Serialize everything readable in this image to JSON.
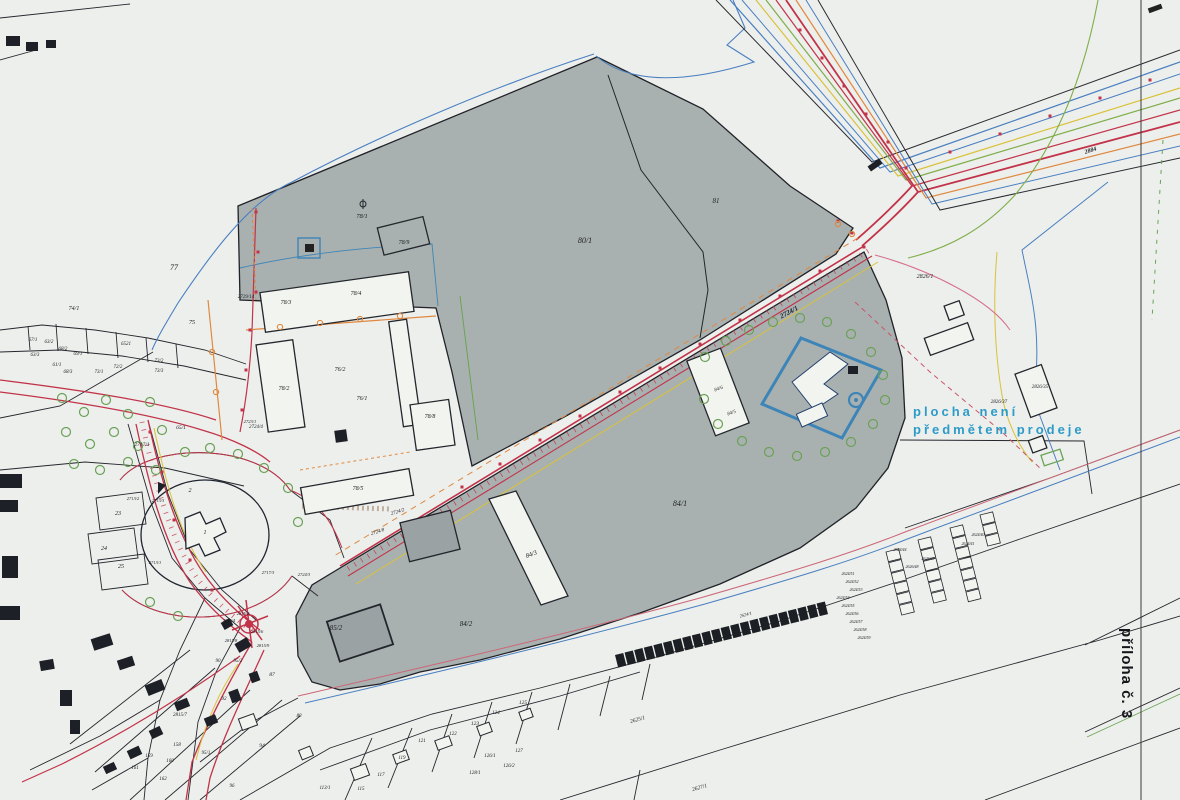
{
  "map": {
    "title": "cadastral-map-scan",
    "annotation_not_for_sale": {
      "line1": "plocha není",
      "line2": "předmětem prodeje",
      "color": "#2d9bc8"
    },
    "attachment_note": "příloha č. 3",
    "main_road_parcel": "2724/1"
  },
  "colors": {
    "paper": "#edefec",
    "parcel_gray": "#a9b1b0",
    "boundary": "#23262c",
    "utility_red": "#c23349",
    "utility_orange": "#e0883f",
    "utility_yellow": "#d9c23a",
    "utility_green": "#6aa455",
    "utility_blue": "#4a7fc1",
    "compound_blue": "#3d85b8",
    "annotation_blue": "#2d9bc8"
  },
  "parcel_labels": [
    {
      "x": 585,
      "y": 243,
      "t": "80/1",
      "fs": 8
    },
    {
      "x": 716,
      "y": 203,
      "t": "81",
      "fs": 7
    },
    {
      "x": 174,
      "y": 270,
      "t": "77",
      "fs": 8
    },
    {
      "x": 74,
      "y": 310,
      "t": "74/1",
      "fs": 6
    },
    {
      "x": 192,
      "y": 324,
      "t": "75",
      "fs": 6
    },
    {
      "x": 362,
      "y": 218,
      "t": "78/1",
      "fs": 6.5
    },
    {
      "x": 404,
      "y": 244,
      "t": "78/9",
      "fs": 6
    },
    {
      "x": 246,
      "y": 298,
      "t": "2729/14",
      "fs": 5
    },
    {
      "x": 286,
      "y": 304,
      "t": "78/3",
      "fs": 6
    },
    {
      "x": 356,
      "y": 295,
      "t": "78/4",
      "fs": 6
    },
    {
      "x": 284,
      "y": 390,
      "t": "78/2",
      "fs": 6
    },
    {
      "x": 340,
      "y": 371,
      "t": "76/2",
      "fs": 6
    },
    {
      "x": 362,
      "y": 400,
      "t": "76/1",
      "fs": 6
    },
    {
      "x": 430,
      "y": 418,
      "t": "78/8",
      "fs": 6
    },
    {
      "x": 358,
      "y": 490,
      "t": "78/5",
      "fs": 6
    },
    {
      "x": 398,
      "y": 513,
      "t": "2724/2",
      "fs": 5,
      "rot": -18
    },
    {
      "x": 378,
      "y": 533,
      "t": "2724/8",
      "fs": 5,
      "rot": -18
    },
    {
      "x": 256,
      "y": 428,
      "t": "2724/4",
      "fs": 5
    },
    {
      "x": 790,
      "y": 314,
      "t": "2724/1",
      "fs": 7,
      "b": 1,
      "rot": -28
    },
    {
      "x": 680,
      "y": 506,
      "t": "84/1",
      "fs": 8
    },
    {
      "x": 532,
      "y": 556,
      "t": "84/3",
      "fs": 6.5,
      "rot": -20
    },
    {
      "x": 466,
      "y": 626,
      "t": "84/2",
      "fs": 7
    },
    {
      "x": 719,
      "y": 390,
      "t": "84/6",
      "fs": 5,
      "rot": -20
    },
    {
      "x": 732,
      "y": 414,
      "t": "84/5",
      "fs": 5,
      "rot": -20
    },
    {
      "x": 336,
      "y": 630,
      "t": "85/2",
      "fs": 7
    },
    {
      "x": 925,
      "y": 278,
      "t": "2826/1",
      "fs": 6
    },
    {
      "x": 1040,
      "y": 388,
      "t": "2826/35",
      "fs": 5
    },
    {
      "x": 999,
      "y": 403,
      "t": "2826/37",
      "fs": 5
    },
    {
      "x": 1091,
      "y": 152,
      "t": "2884",
      "fs": 6,
      "b": 1,
      "rot": -18
    },
    {
      "x": 33,
      "y": 341,
      "t": "67/1",
      "fs": 5
    },
    {
      "x": 49,
      "y": 343,
      "t": "63/2",
      "fs": 5
    },
    {
      "x": 35,
      "y": 356,
      "t": "63/3",
      "fs": 5
    },
    {
      "x": 63,
      "y": 350,
      "t": "68/2",
      "fs": 5
    },
    {
      "x": 78,
      "y": 355,
      "t": "69/1",
      "fs": 5
    },
    {
      "x": 57,
      "y": 366,
      "t": "61/1",
      "fs": 5
    },
    {
      "x": 68,
      "y": 373,
      "t": "68/3",
      "fs": 5
    },
    {
      "x": 126,
      "y": 345,
      "t": "6521",
      "fs": 5
    },
    {
      "x": 99,
      "y": 373,
      "t": "73/1",
      "fs": 5
    },
    {
      "x": 118,
      "y": 368,
      "t": "72/2",
      "fs": 5
    },
    {
      "x": 159,
      "y": 362,
      "t": "73/2",
      "fs": 5
    },
    {
      "x": 159,
      "y": 372,
      "t": "73/3",
      "fs": 5
    },
    {
      "x": 181,
      "y": 429,
      "t": "65/1",
      "fs": 5.5
    },
    {
      "x": 142,
      "y": 446,
      "t": "2717/1",
      "fs": 5.5
    },
    {
      "x": 118,
      "y": 515,
      "t": "23",
      "fs": 6
    },
    {
      "x": 104,
      "y": 550,
      "t": "24",
      "fs": 6
    },
    {
      "x": 121,
      "y": 568,
      "t": "25",
      "fs": 6
    },
    {
      "x": 190,
      "y": 492,
      "t": "2",
      "fs": 6
    },
    {
      "x": 205,
      "y": 534,
      "t": "1",
      "fs": 6
    },
    {
      "x": 133,
      "y": 500,
      "t": "2713/2",
      "fs": 4.5
    },
    {
      "x": 158,
      "y": 502,
      "t": "2713/3",
      "fs": 4.5
    },
    {
      "x": 155,
      "y": 564,
      "t": "2713/1",
      "fs": 4.5
    },
    {
      "x": 268,
      "y": 574,
      "t": "2717/3",
      "fs": 4.5
    },
    {
      "x": 304,
      "y": 576,
      "t": "2724/3",
      "fs": 4.5
    },
    {
      "x": 250,
      "y": 423,
      "t": "2723/1",
      "fs": 4.5
    },
    {
      "x": 243,
      "y": 615,
      "t": "2815/2",
      "fs": 4.5
    },
    {
      "x": 229,
      "y": 622,
      "t": "2815/4",
      "fs": 4.5
    },
    {
      "x": 257,
      "y": 633,
      "t": "2815/6",
      "fs": 4.5
    },
    {
      "x": 263,
      "y": 647,
      "t": "2815/9",
      "fs": 4.5
    },
    {
      "x": 231,
      "y": 642,
      "t": "2815/8",
      "fs": 4.5
    },
    {
      "x": 180,
      "y": 716,
      "t": "2815/7",
      "fs": 5
    },
    {
      "x": 218,
      "y": 662,
      "t": "90",
      "fs": 5
    },
    {
      "x": 238,
      "y": 662,
      "t": "95/2",
      "fs": 5
    },
    {
      "x": 272,
      "y": 676,
      "t": "87",
      "fs": 5.5
    },
    {
      "x": 224,
      "y": 700,
      "t": "92",
      "fs": 5
    },
    {
      "x": 155,
      "y": 733,
      "t": "157",
      "fs": 5
    },
    {
      "x": 177,
      "y": 746,
      "t": "158",
      "fs": 5
    },
    {
      "x": 149,
      "y": 757,
      "t": "159",
      "fs": 5
    },
    {
      "x": 170,
      "y": 762,
      "t": "160",
      "fs": 5
    },
    {
      "x": 135,
      "y": 769,
      "t": "161",
      "fs": 5
    },
    {
      "x": 163,
      "y": 780,
      "t": "162",
      "fs": 5
    },
    {
      "x": 206,
      "y": 754,
      "t": "95/1",
      "fs": 5
    },
    {
      "x": 232,
      "y": 787,
      "t": "96",
      "fs": 5
    },
    {
      "x": 262,
      "y": 747,
      "t": "94",
      "fs": 5.5
    },
    {
      "x": 299,
      "y": 717,
      "t": "88",
      "fs": 5
    },
    {
      "x": 325,
      "y": 789,
      "t": "113/1",
      "fs": 5
    },
    {
      "x": 361,
      "y": 790,
      "t": "115",
      "fs": 5
    },
    {
      "x": 381,
      "y": 776,
      "t": "117",
      "fs": 5
    },
    {
      "x": 402,
      "y": 759,
      "t": "119",
      "fs": 5
    },
    {
      "x": 422,
      "y": 742,
      "t": "121",
      "fs": 5
    },
    {
      "x": 453,
      "y": 735,
      "t": "122",
      "fs": 5
    },
    {
      "x": 475,
      "y": 725,
      "t": "123",
      "fs": 5.5
    },
    {
      "x": 496,
      "y": 714,
      "t": "124",
      "fs": 5
    },
    {
      "x": 523,
      "y": 704,
      "t": "125",
      "fs": 5.5
    },
    {
      "x": 490,
      "y": 757,
      "t": "126/1",
      "fs": 5
    },
    {
      "x": 509,
      "y": 767,
      "t": "126/2",
      "fs": 5
    },
    {
      "x": 475,
      "y": 774,
      "t": "128/1",
      "fs": 5
    },
    {
      "x": 519,
      "y": 752,
      "t": "127",
      "fs": 5
    },
    {
      "x": 638,
      "y": 721,
      "t": "2625/1",
      "fs": 5.5,
      "rot": -16
    },
    {
      "x": 700,
      "y": 789,
      "t": "2627/1",
      "fs": 5.5,
      "rot": -16
    },
    {
      "x": 746,
      "y": 616,
      "t": "2624/1",
      "fs": 4.5,
      "rot": -15
    },
    {
      "x": 848,
      "y": 575,
      "t": "2624/51",
      "fs": 4
    },
    {
      "x": 852,
      "y": 583,
      "t": "2624/52",
      "fs": 4
    },
    {
      "x": 856,
      "y": 591,
      "t": "2624/53",
      "fs": 4
    },
    {
      "x": 843,
      "y": 599,
      "t": "2624/54",
      "fs": 4
    },
    {
      "x": 848,
      "y": 607,
      "t": "2624/55",
      "fs": 4
    },
    {
      "x": 852,
      "y": 615,
      "t": "2624/56",
      "fs": 4
    },
    {
      "x": 856,
      "y": 623,
      "t": "2624/57",
      "fs": 4
    },
    {
      "x": 860,
      "y": 631,
      "t": "2624/58",
      "fs": 4
    },
    {
      "x": 864,
      "y": 639,
      "t": "2624/59",
      "fs": 4
    },
    {
      "x": 912,
      "y": 568,
      "t": "2626/48",
      "fs": 4
    },
    {
      "x": 928,
      "y": 560,
      "t": "2626/49",
      "fs": 4
    },
    {
      "x": 900,
      "y": 551,
      "t": "2624/44",
      "fs": 4
    },
    {
      "x": 968,
      "y": 545,
      "t": "2624/41",
      "fs": 4
    },
    {
      "x": 978,
      "y": 536,
      "t": "2624/40",
      "fs": 4
    }
  ]
}
